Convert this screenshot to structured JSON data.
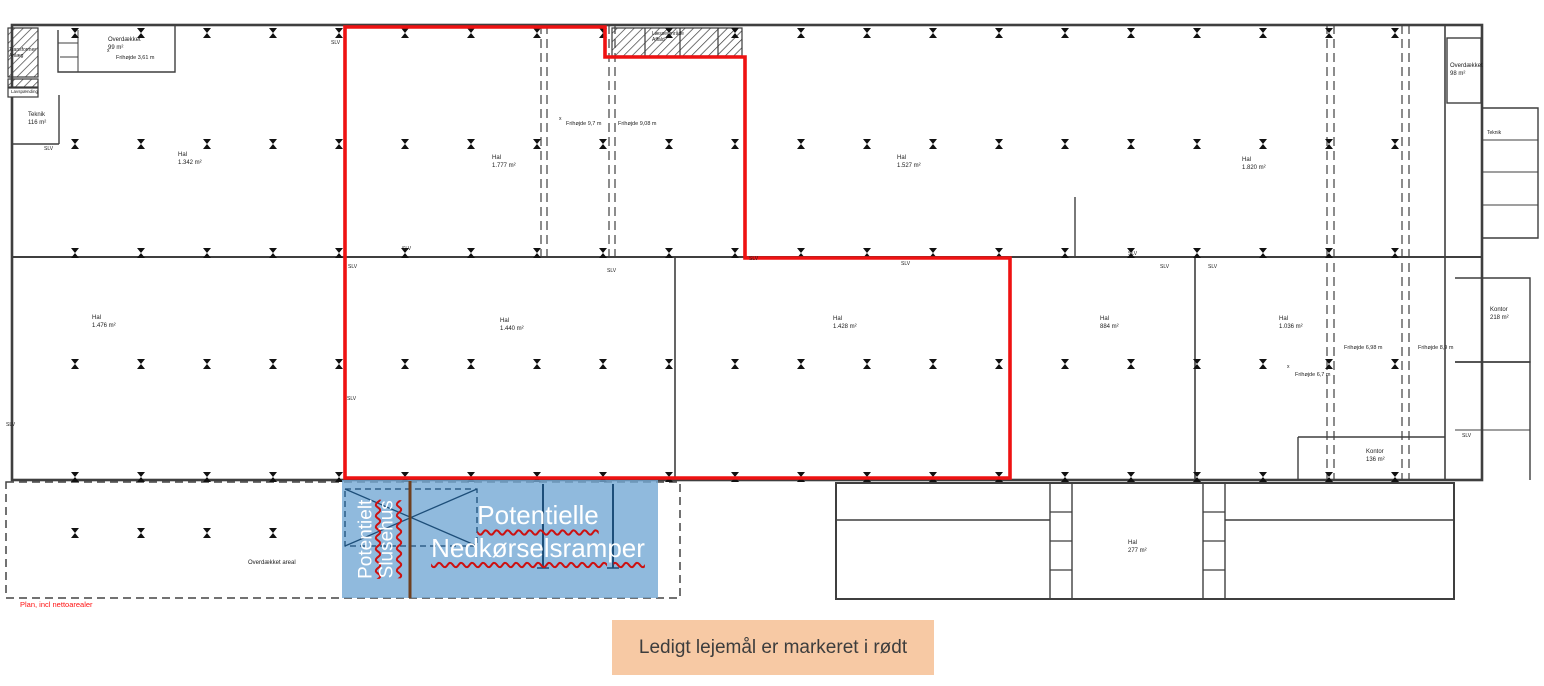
{
  "plan": {
    "caption": "Plan, incl nettoarealer",
    "legend": "Ledigt lejemål er markeret i rødt",
    "colors": {
      "lease_outline": "#ee1212",
      "overlay_fill": "#74a9d4",
      "overlay_divider": "#6e3f1e",
      "banner_bg": "#f7c9a4",
      "wall": "#3f3f3f",
      "caption_red": "#ff1010"
    },
    "overlay": {
      "slusehus_line1": "Potentielt",
      "slusehus_line2": "Slusehus",
      "ramps_line1": "Potentielle",
      "ramps_line2": "Nedkørselsramper"
    },
    "rooms": [
      {
        "line1": "Hal",
        "line2": "1.342 m²",
        "x": 178,
        "y": 152
      },
      {
        "line1": "Hal",
        "line2": "1.777 m²",
        "x": 492,
        "y": 155
      },
      {
        "line1": "Hal",
        "line2": "1.527 m²",
        "x": 897,
        "y": 155
      },
      {
        "line1": "Hal",
        "line2": "1.820 m²",
        "x": 1242,
        "y": 157
      },
      {
        "line1": "Hal",
        "line2": "1.476 m²",
        "x": 92,
        "y": 315
      },
      {
        "line1": "Hal",
        "line2": "1.440 m²",
        "x": 500,
        "y": 318
      },
      {
        "line1": "Hal",
        "line2": "1.428 m²",
        "x": 833,
        "y": 316
      },
      {
        "line1": "Hal",
        "line2": "884 m²",
        "x": 1100,
        "y": 316
      },
      {
        "line1": "Hal",
        "line2": "1.036 m²",
        "x": 1279,
        "y": 316
      },
      {
        "line1": "Hal",
        "line2": "277 m²",
        "x": 1128,
        "y": 540
      },
      {
        "line1": "Overdækket",
        "line2": "99 m²",
        "x": 108,
        "y": 37
      },
      {
        "line1": "Overdækket",
        "line2": "98 m²",
        "x": 1450,
        "y": 63
      },
      {
        "line1": "Teknik",
        "line2": "116 m²",
        "x": 28,
        "y": 112
      },
      {
        "line1": "Teknik",
        "line2": "",
        "x": 1487,
        "y": 130,
        "cls": "xs"
      },
      {
        "line1": "Kontor",
        "line2": "218 m²",
        "x": 1490,
        "y": 307
      },
      {
        "line1": "Kontor",
        "line2": "136 m²",
        "x": 1366,
        "y": 449
      },
      {
        "line1": "Overdækket areal",
        "line2": "",
        "x": 248,
        "y": 560
      },
      {
        "line1": "Transformer",
        "line2": "Anlæg",
        "x": 9,
        "y": 47,
        "cls": "xs"
      },
      {
        "line1": "Læsseområde",
        "line2": "Affald",
        "x": 652,
        "y": 31,
        "cls": "xs"
      },
      {
        "line1": "Lavspænding",
        "line2": "",
        "x": 11,
        "y": 89,
        "cls": "xxs"
      }
    ],
    "annotations": [
      {
        "text": "SLV",
        "x": 44,
        "y": 146,
        "kind": "slv"
      },
      {
        "text": "SLV",
        "x": 331,
        "y": 40,
        "kind": "slv"
      },
      {
        "text": "SLV",
        "x": 348,
        "y": 264,
        "kind": "slv"
      },
      {
        "text": "SLV",
        "x": 402,
        "y": 246,
        "kind": "slv"
      },
      {
        "text": "SLV",
        "x": 607,
        "y": 268,
        "kind": "slv"
      },
      {
        "text": "SLV",
        "x": 749,
        "y": 256,
        "kind": "slv"
      },
      {
        "text": "SLV",
        "x": 901,
        "y": 261,
        "kind": "slv"
      },
      {
        "text": "SLV",
        "x": 1128,
        "y": 251,
        "kind": "slv"
      },
      {
        "text": "SLV",
        "x": 1160,
        "y": 264,
        "kind": "slv"
      },
      {
        "text": "SLV",
        "x": 1208,
        "y": 264,
        "kind": "slv"
      },
      {
        "text": "SLV",
        "x": 6,
        "y": 422,
        "kind": "slv"
      },
      {
        "text": "SLV",
        "x": 347,
        "y": 396,
        "kind": "slv"
      },
      {
        "text": "SLV",
        "x": 1462,
        "y": 433,
        "kind": "slv"
      },
      {
        "text": "Frihøjde 3,61 m",
        "x": 116,
        "y": 55,
        "kind": "fri"
      },
      {
        "text": "Frihøjde 9,7 m",
        "x": 566,
        "y": 121,
        "kind": "fri"
      },
      {
        "text": "Frihøjde 9,08 m",
        "x": 618,
        "y": 121,
        "kind": "fri"
      },
      {
        "text": "Frihøjde 6,98 m",
        "x": 1344,
        "y": 345,
        "kind": "fri"
      },
      {
        "text": "Frihøjde 8,9 m",
        "x": 1418,
        "y": 345,
        "kind": "fri"
      },
      {
        "text": "Frihøjde 6,7 m",
        "x": 1295,
        "y": 372,
        "kind": "fri"
      },
      {
        "text": "x",
        "x": 559,
        "y": 116,
        "kind": "x"
      },
      {
        "text": "x",
        "x": 1287,
        "y": 364,
        "kind": "x"
      },
      {
        "text": "x",
        "x": 107,
        "y": 48,
        "kind": "x"
      }
    ]
  }
}
